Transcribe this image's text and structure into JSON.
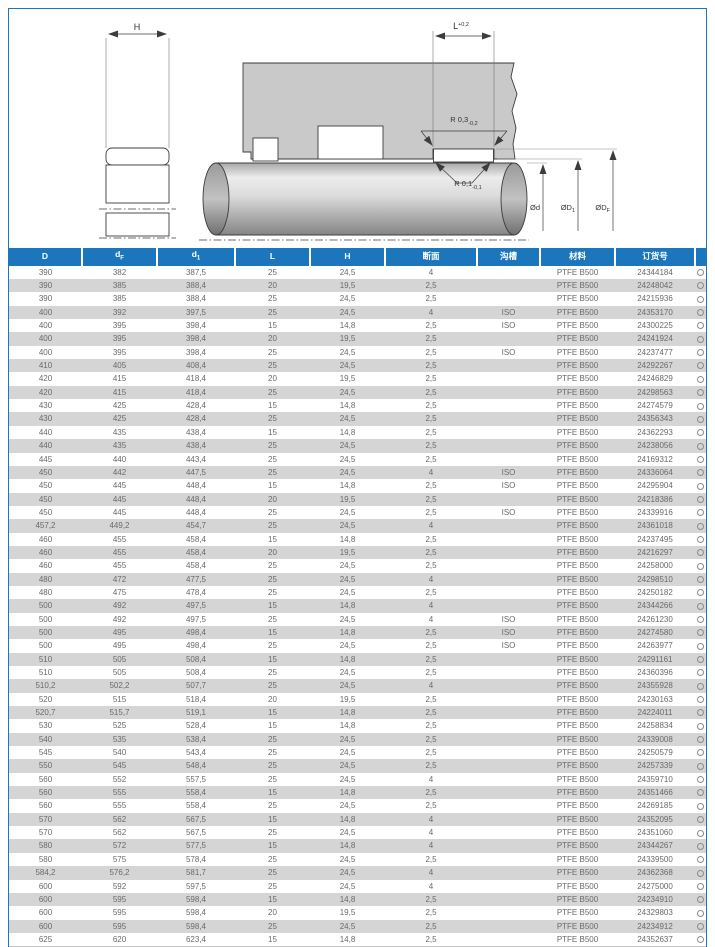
{
  "drawing": {
    "labels": {
      "h": "H",
      "l": "L",
      "l_tol": "+0,2",
      "r_outer": "R 0,3",
      "r_outer_tol": "-0,2",
      "r_inner": "R 0,1",
      "r_inner_tol": "-0,1",
      "dia_d": "Ød",
      "dia_d1": "ØD",
      "dia_d1_sub": "1",
      "dia_df": "ØD",
      "dia_df_sub": "F"
    }
  },
  "table": {
    "columns": [
      {
        "name": "D",
        "label": "D",
        "sub": ""
      },
      {
        "name": "dF",
        "label": "d",
        "sub": "F"
      },
      {
        "name": "d1",
        "label": "d",
        "sub": "1"
      },
      {
        "name": "L",
        "label": "L",
        "sub": ""
      },
      {
        "name": "H",
        "label": "H",
        "sub": ""
      },
      {
        "name": "cross-section",
        "label": "断面",
        "sub": ""
      },
      {
        "name": "groove",
        "label": "沟槽",
        "sub": ""
      },
      {
        "name": "material",
        "label": "材料",
        "sub": ""
      },
      {
        "name": "order-number",
        "label": "订货号",
        "sub": ""
      },
      {
        "name": "availability",
        "label": "",
        "sub": ""
      }
    ],
    "availability_symbol": "○",
    "rows": [
      [
        "390",
        "382",
        "387,5",
        "25",
        "24,5",
        "4",
        "",
        "PTFE B500",
        "24344184"
      ],
      [
        "390",
        "385",
        "388,4",
        "20",
        "19,5",
        "2,5",
        "",
        "PTFE B500",
        "24248042"
      ],
      [
        "390",
        "385",
        "388,4",
        "25",
        "24,5",
        "2,5",
        "",
        "PTFE B500",
        "24215936"
      ],
      [
        "400",
        "392",
        "397,5",
        "25",
        "24,5",
        "4",
        "ISO",
        "PTFE B500",
        "24353170"
      ],
      [
        "400",
        "395",
        "398,4",
        "15",
        "14,8",
        "2,5",
        "ISO",
        "PTFE B500",
        "24300225"
      ],
      [
        "400",
        "395",
        "398,4",
        "20",
        "19,5",
        "2,5",
        "",
        "PTFE B500",
        "24241924"
      ],
      [
        "400",
        "395",
        "398,4",
        "25",
        "24,5",
        "2,5",
        "ISO",
        "PTFE B500",
        "24237477"
      ],
      [
        "410",
        "405",
        "408,4",
        "25",
        "24,5",
        "2,5",
        "",
        "PTFE B500",
        "24292267"
      ],
      [
        "420",
        "415",
        "418,4",
        "20",
        "19,5",
        "2,5",
        "",
        "PTFE B500",
        "24246829"
      ],
      [
        "420",
        "415",
        "418,4",
        "25",
        "24,5",
        "2,5",
        "",
        "PTFE B500",
        "24298563"
      ],
      [
        "430",
        "425",
        "428,4",
        "15",
        "14,8",
        "2,5",
        "",
        "PTFE B500",
        "24274579"
      ],
      [
        "430",
        "425",
        "428,4",
        "25",
        "24,5",
        "2,5",
        "",
        "PTFE B500",
        "24356343"
      ],
      [
        "440",
        "435",
        "438,4",
        "15",
        "14,8",
        "2,5",
        "",
        "PTFE B500",
        "24362293"
      ],
      [
        "440",
        "435",
        "438,4",
        "25",
        "24,5",
        "2,5",
        "",
        "PTFE B500",
        "24238056"
      ],
      [
        "445",
        "440",
        "443,4",
        "25",
        "24,5",
        "2,5",
        "",
        "PTFE B500",
        "24169312"
      ],
      [
        "450",
        "442",
        "447,5",
        "25",
        "24,5",
        "4",
        "ISO",
        "PTFE B500",
        "24336064"
      ],
      [
        "450",
        "445",
        "448,4",
        "15",
        "14,8",
        "2,5",
        "ISO",
        "PTFE B500",
        "24295904"
      ],
      [
        "450",
        "445",
        "448,4",
        "20",
        "19,5",
        "2,5",
        "",
        "PTFE B500",
        "24218386"
      ],
      [
        "450",
        "445",
        "448,4",
        "25",
        "24,5",
        "2,5",
        "ISO",
        "PTFE B500",
        "24339916"
      ],
      [
        "457,2",
        "449,2",
        "454,7",
        "25",
        "24,5",
        "4",
        "",
        "PTFE B500",
        "24361018"
      ],
      [
        "460",
        "455",
        "458,4",
        "15",
        "14,8",
        "2,5",
        "",
        "PTFE B500",
        "24237495"
      ],
      [
        "460",
        "455",
        "458,4",
        "20",
        "19,5",
        "2,5",
        "",
        "PTFE B500",
        "24216297"
      ],
      [
        "460",
        "455",
        "458,4",
        "25",
        "24,5",
        "2,5",
        "",
        "PTFE B500",
        "24258000"
      ],
      [
        "480",
        "472",
        "477,5",
        "25",
        "24,5",
        "4",
        "",
        "PTFE B500",
        "24298510"
      ],
      [
        "480",
        "475",
        "478,4",
        "25",
        "24,5",
        "2,5",
        "",
        "PTFE B500",
        "24250182"
      ],
      [
        "500",
        "492",
        "497,5",
        "15",
        "14,8",
        "4",
        "",
        "PTFE B500",
        "24344266"
      ],
      [
        "500",
        "492",
        "497,5",
        "25",
        "24,5",
        "4",
        "ISO",
        "PTFE B500",
        "24261230"
      ],
      [
        "500",
        "495",
        "498,4",
        "15",
        "14,8",
        "2,5",
        "ISO",
        "PTFE B500",
        "24274580"
      ],
      [
        "500",
        "495",
        "498,4",
        "25",
        "24,5",
        "2,5",
        "ISO",
        "PTFE B500",
        "24263977"
      ],
      [
        "510",
        "505",
        "508,4",
        "15",
        "14,8",
        "2,5",
        "",
        "PTFE B500",
        "24291161"
      ],
      [
        "510",
        "505",
        "508,4",
        "25",
        "24,5",
        "2,5",
        "",
        "PTFE B500",
        "24360396"
      ],
      [
        "510,2",
        "502,2",
        "507,7",
        "25",
        "24,5",
        "4",
        "",
        "PTFE B500",
        "24355928"
      ],
      [
        "520",
        "515",
        "518,4",
        "20",
        "19,5",
        "2,5",
        "",
        "PTFE B500",
        "24230163"
      ],
      [
        "520,7",
        "515,7",
        "519,1",
        "15",
        "14,8",
        "2,5",
        "",
        "PTFE B500",
        "24224011"
      ],
      [
        "530",
        "525",
        "528,4",
        "15",
        "14,8",
        "2,5",
        "",
        "PTFE B500",
        "24258834"
      ],
      [
        "540",
        "535",
        "538,4",
        "25",
        "24,5",
        "2,5",
        "",
        "PTFE B500",
        "24339008"
      ],
      [
        "545",
        "540",
        "543,4",
        "25",
        "24,5",
        "2,5",
        "",
        "PTFE B500",
        "24250579"
      ],
      [
        "550",
        "545",
        "548,4",
        "25",
        "24,5",
        "2,5",
        "",
        "PTFE B500",
        "24257339"
      ],
      [
        "560",
        "552",
        "557,5",
        "25",
        "24,5",
        "4",
        "",
        "PTFE B500",
        "24359710"
      ],
      [
        "560",
        "555",
        "558,4",
        "15",
        "14,8",
        "2,5",
        "",
        "PTFE B500",
        "24351466"
      ],
      [
        "560",
        "555",
        "558,4",
        "25",
        "24,5",
        "2,5",
        "",
        "PTFE B500",
        "24269185"
      ],
      [
        "570",
        "562",
        "567,5",
        "15",
        "14,8",
        "4",
        "",
        "PTFE B500",
        "24352095"
      ],
      [
        "570",
        "562",
        "567,5",
        "25",
        "24,5",
        "4",
        "",
        "PTFE B500",
        "24351060"
      ],
      [
        "580",
        "572",
        "577,5",
        "15",
        "14,8",
        "4",
        "",
        "PTFE B500",
        "24344267"
      ],
      [
        "580",
        "575",
        "578,4",
        "25",
        "24,5",
        "2,5",
        "",
        "PTFE B500",
        "24339500"
      ],
      [
        "584,2",
        "576,2",
        "581,7",
        "25",
        "24,5",
        "4",
        "",
        "PTFE B500",
        "24362368"
      ],
      [
        "600",
        "592",
        "597,5",
        "25",
        "24,5",
        "4",
        "",
        "PTFE B500",
        "24275000"
      ],
      [
        "600",
        "595",
        "598,4",
        "15",
        "14,8",
        "2,5",
        "",
        "PTFE B500",
        "24234910"
      ],
      [
        "600",
        "595",
        "598,4",
        "20",
        "19,5",
        "2,5",
        "",
        "PTFE B500",
        "24329803"
      ],
      [
        "600",
        "595",
        "598,4",
        "25",
        "24,5",
        "2,5",
        "",
        "PTFE B500",
        "24234912"
      ],
      [
        "625",
        "620",
        "623,4",
        "15",
        "14,8",
        "2,5",
        "",
        "PTFE B500",
        "24352637"
      ]
    ]
  },
  "colors": {
    "accent_blue": "#1b76bb",
    "stripe_gray": "#d5d5d5",
    "housing_gray": "#c9c9c9",
    "text_gray": "#6a6a6a"
  }
}
